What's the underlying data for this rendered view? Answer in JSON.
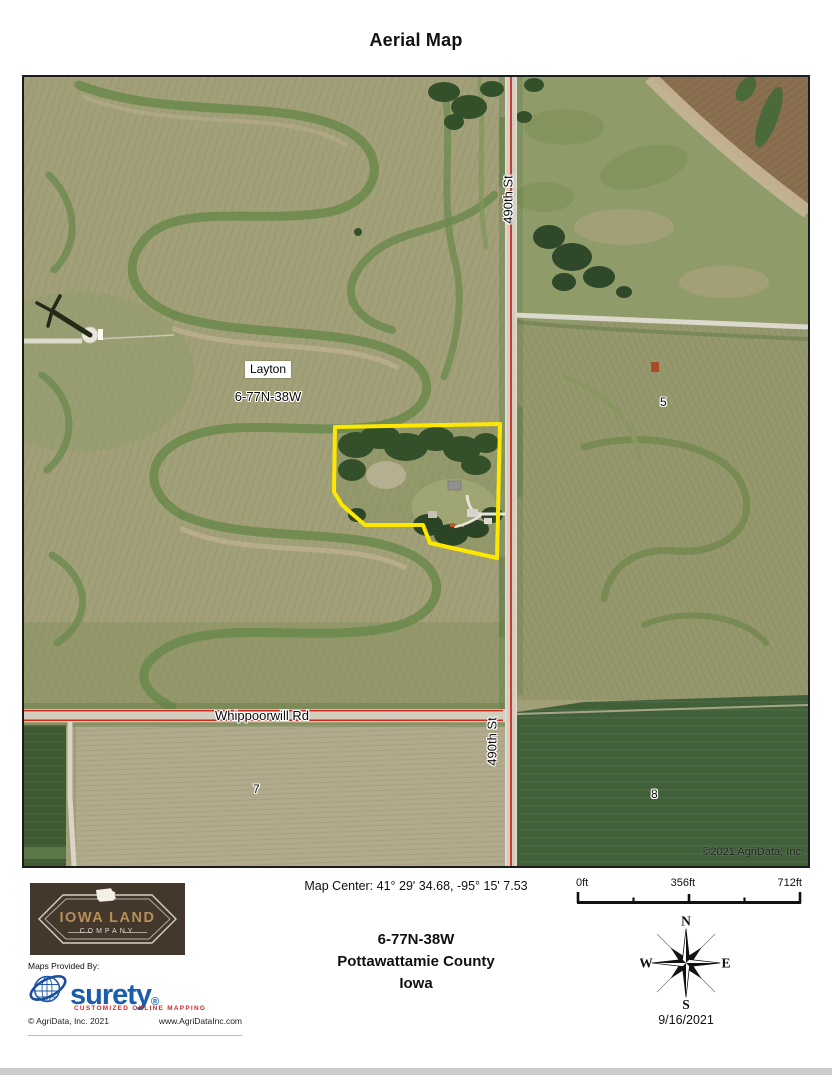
{
  "title": "Aerial Map",
  "map": {
    "labels": {
      "town": "Layton",
      "township": "6-77N-38W",
      "road_490": "490th St",
      "road_whippoorwill": "Whippoorwill Rd",
      "section_5": "5",
      "section_7": "7",
      "section_8": "8",
      "copyright": "©2021 AgriData, Inc."
    }
  },
  "footer": {
    "map_center": "Map Center: 41° 29' 34.68,  -95° 15' 7.53",
    "township_id": "6-77N-38W",
    "county": "Pottawattamie County",
    "state": "Iowa",
    "scale": {
      "labels": [
        "0ft",
        "356ft",
        "712ft"
      ]
    },
    "compass": {
      "n": "N",
      "e": "E",
      "s": "S",
      "w": "W"
    },
    "date": "9/16/2021",
    "iowa_land": {
      "line1": "IOWA LAND",
      "line2": "COMPANY"
    },
    "provider": {
      "heading": "Maps Provided By:",
      "brand": "surety",
      "registered": "®",
      "tagline": "CUSTOMIZED ONLINE MAPPING",
      "copyright": "© AgriData, Inc. 2021",
      "website": "www.AgriDataInc.com"
    }
  },
  "colors": {
    "parcel_outline": "#ffe800",
    "road_line": "#cf2a1b",
    "surety_blue": "#1a5dab",
    "tagline_red": "#cc2a2a",
    "logo_brown": "#44382c",
    "logo_gold": "#b5905a"
  }
}
